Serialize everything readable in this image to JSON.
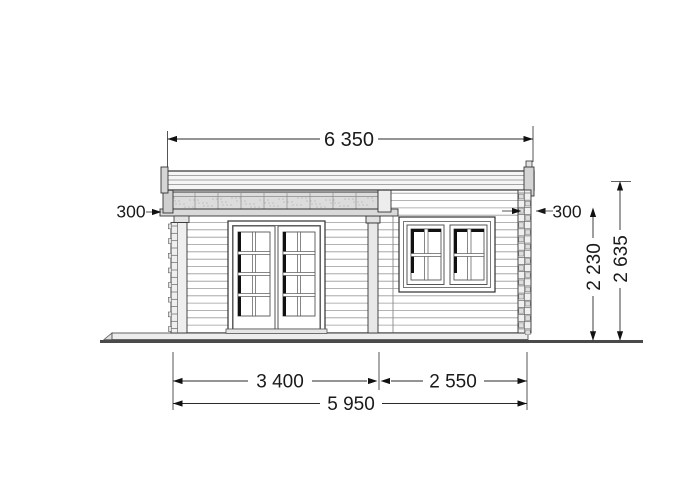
{
  "dimensions": {
    "roof_width": "6 350",
    "left_overhang": "300",
    "right_overhang": "300",
    "wall_height": "2 230",
    "total_height": "2 635",
    "left_section_width": "3 400",
    "right_section_width": "2 550",
    "total_width": "5 950"
  },
  "colors": {
    "line": "#2f2f2f",
    "mid_line": "#555555",
    "siding_line": "#9b9b9b",
    "ground": "#4a4a4a",
    "fill_light": "#ececec",
    "fill_beam": "#dcdcdc",
    "glass_shadow": "#111111",
    "background": "#ffffff"
  }
}
